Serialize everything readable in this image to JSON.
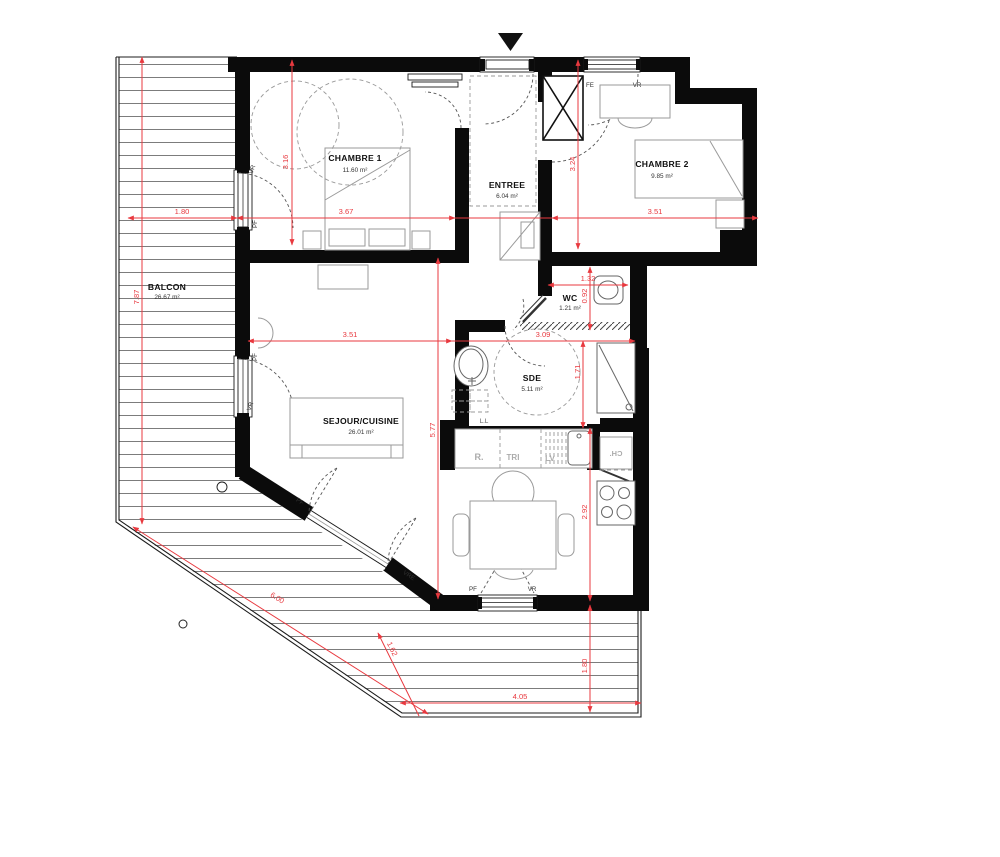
{
  "plan": {
    "rooms": [
      {
        "id": "chambre1",
        "name": "CHAMBRE 1",
        "area": "11.60 m²"
      },
      {
        "id": "chambre2",
        "name": "CHAMBRE 2",
        "area": "9.85 m²"
      },
      {
        "id": "entree",
        "name": "ENTREE",
        "area": "6.04 m²"
      },
      {
        "id": "wc",
        "name": "WC",
        "area": "1.21 m²"
      },
      {
        "id": "sde",
        "name": "SDE",
        "area": "5.11 m²"
      },
      {
        "id": "sejour",
        "name": "SEJOUR/CUISINE",
        "area": "26.01 m²"
      },
      {
        "id": "balcon",
        "name": "BALCON",
        "area": "26.67 m²"
      }
    ],
    "dimensions_m": [
      {
        "id": "balcon-top-width",
        "value": "1.80"
      },
      {
        "id": "chambre1-width",
        "value": "3.67"
      },
      {
        "id": "chambre2-width",
        "value": "3.51"
      },
      {
        "id": "chambre1-height",
        "value": "3.16"
      },
      {
        "id": "entree-height",
        "value": "3.24"
      },
      {
        "id": "balcon-left-height",
        "value": "7.87"
      },
      {
        "id": "wc-width",
        "value": "1.32"
      },
      {
        "id": "wc-height",
        "value": "0.92"
      },
      {
        "id": "sejour-width",
        "value": "3.51"
      },
      {
        "id": "sde-width",
        "value": "3.09"
      },
      {
        "id": "sde-height",
        "value": "1.71"
      },
      {
        "id": "sejour-height",
        "value": "5.77"
      },
      {
        "id": "cuisine-height",
        "value": "2.92"
      },
      {
        "id": "balcon-bottom-depth",
        "value": "1.80"
      },
      {
        "id": "balcon-bottom-width",
        "value": "4.05"
      },
      {
        "id": "balcon-diagonal",
        "value": "6.00"
      },
      {
        "id": "balcon-diagonal-depth",
        "value": "1.62"
      }
    ],
    "opening_labels": [
      {
        "id": "fe-top",
        "text": "FE"
      },
      {
        "id": "vr-top",
        "text": "VR"
      },
      {
        "id": "vr-chambre1",
        "text": "VR"
      },
      {
        "id": "pf-chambre1",
        "text": "PF"
      },
      {
        "id": "pf-sejour-left",
        "text": "PF"
      },
      {
        "id": "vr-sejour-left",
        "text": "VR"
      },
      {
        "id": "pf-diagonal",
        "text": "PF"
      },
      {
        "id": "vre-diagonal",
        "text": "VRE"
      },
      {
        "id": "pf-bottom",
        "text": "PF"
      },
      {
        "id": "vr-bottom",
        "text": "VR"
      }
    ],
    "fixture_labels": [
      {
        "id": "refrigerateur",
        "text": "R."
      },
      {
        "id": "tri",
        "text": "TRI"
      },
      {
        "id": "lave-vaisselle",
        "text": "LV"
      },
      {
        "id": "lave-linge",
        "text": "L.L"
      },
      {
        "id": "chaudiere",
        "text": "CH."
      }
    ],
    "colors": {
      "dimension_red": "#e8393f",
      "wall_black": "#0b0b0b"
    }
  }
}
